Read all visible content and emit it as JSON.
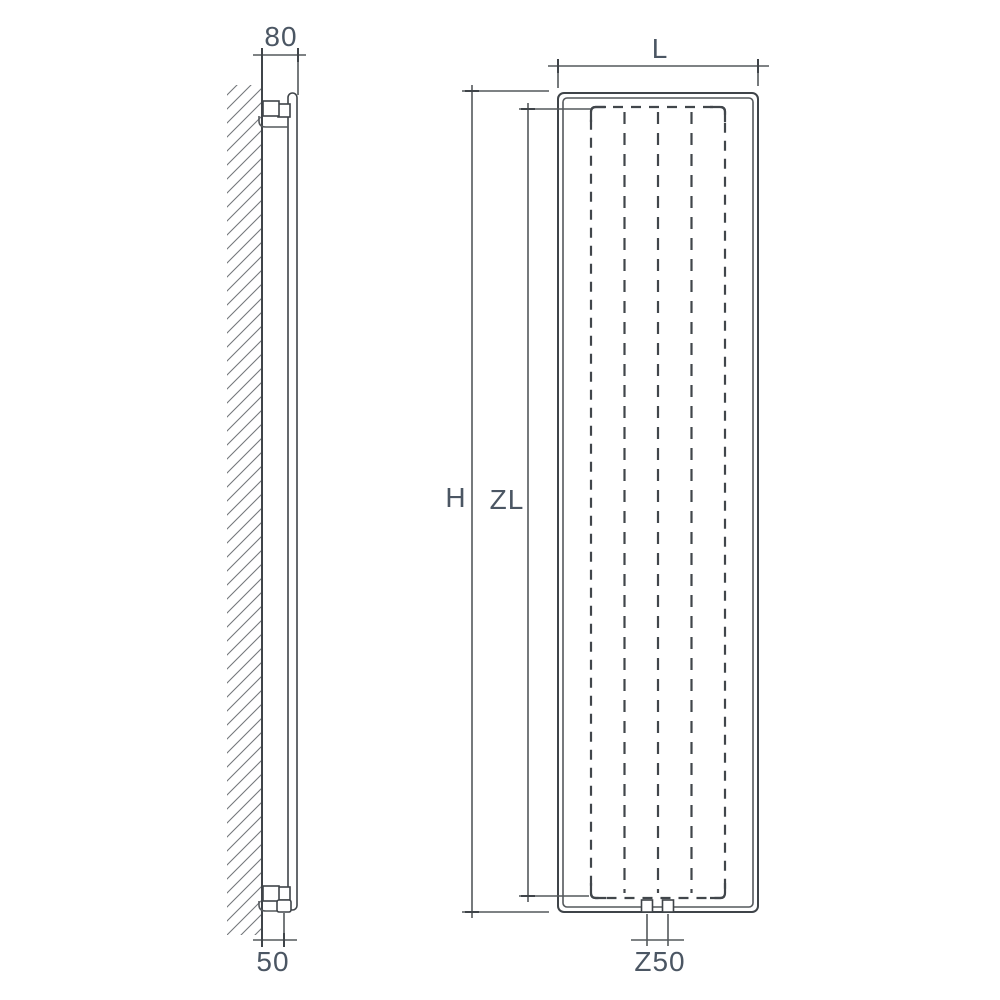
{
  "drawing": {
    "kind": "radiator-technical-dimension-drawing",
    "views": [
      "side-view",
      "front-view"
    ]
  },
  "labels": {
    "depth_from_wall": "80",
    "bottom_wall_distance": "50",
    "length": "L",
    "height": "H",
    "inner_height": "ZL",
    "connection_spacing": "Z50"
  },
  "colors": {
    "background": "#ffffff",
    "line": "#3f4449",
    "thin_line": "#54585c",
    "hatch": "#74787c",
    "dimension_text": "#4b5663"
  }
}
